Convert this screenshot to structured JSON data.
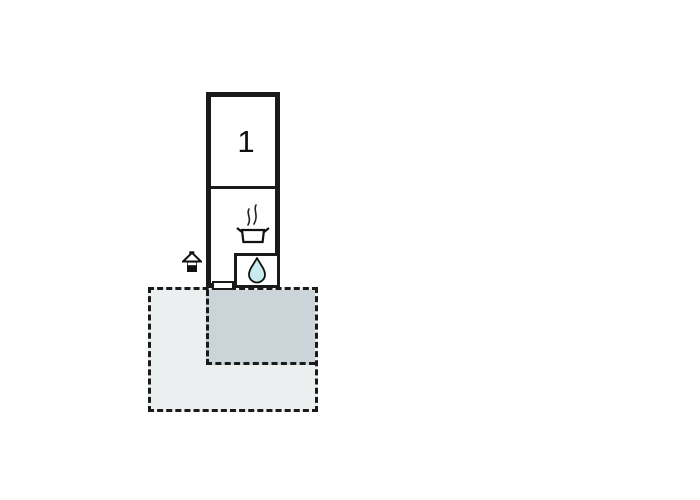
{
  "floorplan": {
    "room": {
      "label": "1"
    },
    "icons": {
      "cooking_pot": "cooking-pot-icon",
      "steam": "steam-icon",
      "water_drop": "water-drop-icon",
      "house": "house-entrance-icon"
    },
    "colors": {
      "wall": "#1a1a1a",
      "terrace_fill": "#eceff0",
      "patio_fill": "#cbd5d9",
      "drop_fill": "#c7ebee",
      "room_fill": "#ffffff",
      "background": "#ffffff"
    }
  }
}
